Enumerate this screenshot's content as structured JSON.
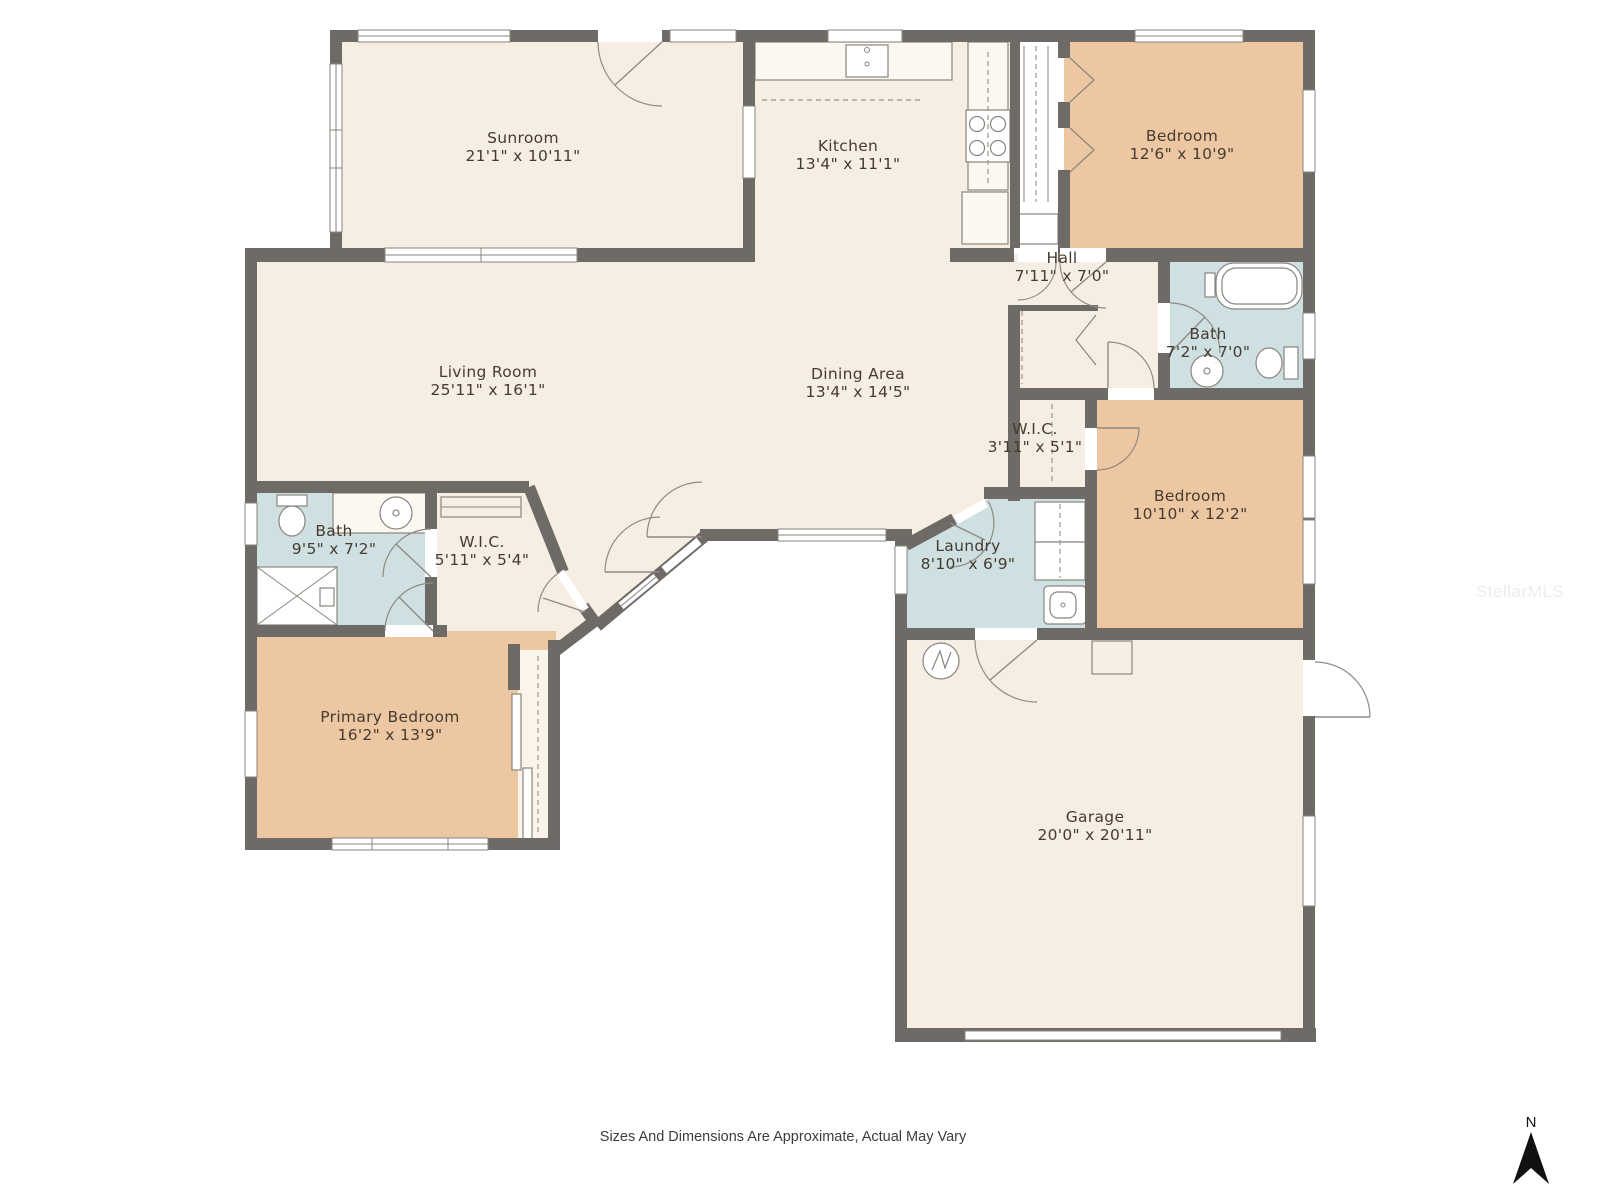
{
  "colors": {
    "floor": "#f7eee3",
    "floor_light": "#faf4ea",
    "bedroom": "#edc7a2",
    "wet": "#cfe0e2",
    "wall": "#6e6a66",
    "fixture_outline": "#8a857e",
    "label_text": "#463b30",
    "footer_text": "#3d3d3d",
    "watermark_text": "#ececec",
    "north_arrow": "#111111"
  },
  "rooms": [
    {
      "name": "Sunroom",
      "dims": "21'1\" x 10'11\""
    },
    {
      "name": "Kitchen",
      "dims": "13'4\" x 11'1\""
    },
    {
      "name": "Bedroom",
      "dims": "12'6\" x 10'9\""
    },
    {
      "name": "Hall",
      "dims": "7'11\" x 7'0\""
    },
    {
      "name": "Bath",
      "dims": "7'2\" x 7'0\""
    },
    {
      "name": "Living Room",
      "dims": "25'11\" x 16'1\""
    },
    {
      "name": "Dining Area",
      "dims": "13'4\" x 14'5\""
    },
    {
      "name": "W.I.C.",
      "dims": "3'11\" x 5'1\""
    },
    {
      "name": "Bedroom",
      "dims": "10'10\" x 12'2\""
    },
    {
      "name": "Bath",
      "dims": "9'5\" x 7'2\""
    },
    {
      "name": "W.I.C.",
      "dims": "5'11\" x 5'4\""
    },
    {
      "name": "Laundry",
      "dims": "8'10\" x 6'9\""
    },
    {
      "name": "Primary Bedroom",
      "dims": "16'2\" x 13'9\""
    },
    {
      "name": "Garage",
      "dims": "20'0\" x 20'11\""
    }
  ],
  "footer": {
    "disclaimer": "Sizes And Dimensions Are Approximate, Actual May Vary"
  },
  "watermark": {
    "text": "StellarMLS"
  },
  "compass": {
    "label": "N"
  }
}
